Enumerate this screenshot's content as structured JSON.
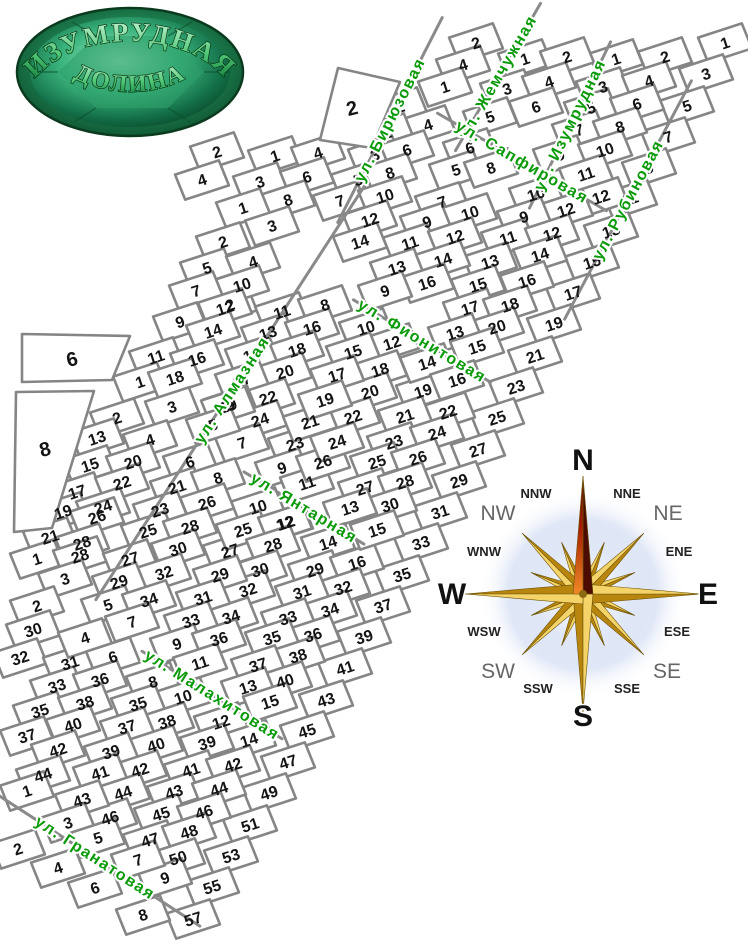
{
  "logo": {
    "line1": "ИЗУМРУДНАЯ",
    "line2": "ДОЛИНА"
  },
  "colors": {
    "street_label": "#0a9a0a",
    "parcel_line": "#858585",
    "number": "#141414",
    "compass_gold_light": "#f4d469",
    "compass_gold_dark": "#b8860f",
    "compass_north_dark": "#4d0c00",
    "logo_green": "#1d7f4e"
  },
  "streets": [
    {
      "name": "ул. Алмазная",
      "x": 232,
      "y": 390,
      "rot": -57,
      "line": 500
    },
    {
      "name": "ул. Бирюзовая",
      "x": 390,
      "y": 120,
      "rot": -63,
      "line": 230
    },
    {
      "name": "ул. Жемчужная",
      "x": 498,
      "y": 77,
      "rot": -60,
      "line": 170
    },
    {
      "name": "ул. Изумрудная",
      "x": 570,
      "y": 125,
      "rot": -64,
      "line": 185
    },
    {
      "name": "ул. Рубиновая",
      "x": 628,
      "y": 200,
      "rot": -62,
      "line": 270
    },
    {
      "name": "ул. Сапфировая",
      "x": 522,
      "y": 162,
      "rot": 30,
      "line": 195
    },
    {
      "name": "ул. Фионитовая",
      "x": 422,
      "y": 341,
      "rot": 31,
      "line": 160
    },
    {
      "name": "ул. Янтарная",
      "x": 304,
      "y": 508,
      "rot": 31,
      "line": 140
    },
    {
      "name": "ул. Малахитовая",
      "x": 212,
      "y": 695,
      "rot": 32,
      "line": 165
    },
    {
      "name": "ул. Гранатовая",
      "x": 95,
      "y": 858,
      "rot": 33,
      "line": 250
    }
  ],
  "big_plots": [
    {
      "n": "6",
      "points": "22,334 130,336 112,380 22,382",
      "lx": 72,
      "ly": 359
    },
    {
      "n": "8",
      "points": "16,392 94,391 52,528 14,532",
      "lx": 45,
      "ly": 449
    },
    {
      "n": "2",
      "points": "320,140 338,68 400,82 372,148",
      "lx": 352,
      "ly": 108
    }
  ],
  "plots": [
    [
      1,
      725,
      43
    ],
    [
      3,
      706,
      74
    ],
    [
      5,
      687,
      106
    ],
    [
      7,
      668,
      137
    ],
    [
      9,
      649,
      168
    ],
    [
      11,
      630,
      199
    ],
    [
      13,
      611,
      231
    ],
    [
      15,
      592,
      262
    ],
    [
      17,
      573,
      293
    ],
    [
      19,
      554,
      324
    ],
    [
      21,
      535,
      356
    ],
    [
      23,
      516,
      387
    ],
    [
      25,
      497,
      418
    ],
    [
      27,
      478,
      450
    ],
    [
      29,
      459,
      481
    ],
    [
      31,
      440,
      512
    ],
    [
      33,
      421,
      543
    ],
    [
      35,
      402,
      575
    ],
    [
      37,
      383,
      606
    ],
    [
      39,
      364,
      637
    ],
    [
      41,
      345,
      668
    ],
    [
      43,
      326,
      700
    ],
    [
      45,
      307,
      731
    ],
    [
      47,
      288,
      762
    ],
    [
      49,
      269,
      793
    ],
    [
      51,
      250,
      825
    ],
    [
      53,
      231,
      856
    ],
    [
      55,
      212,
      887
    ],
    [
      57,
      193,
      919
    ],
    [
      1,
      616,
      59
    ],
    [
      2,
      665,
      57
    ],
    [
      3,
      603,
      87
    ],
    [
      4,
      649,
      81
    ],
    [
      5,
      591,
      108
    ],
    [
      6,
      637,
      104
    ],
    [
      7,
      579,
      130
    ],
    [
      8,
      620,
      127
    ],
    [
      9,
      560,
      155
    ],
    [
      10,
      605,
      150
    ],
    [
      11,
      586,
      174
    ],
    [
      12,
      601,
      197
    ],
    [
      1,
      525,
      59
    ],
    [
      2,
      567,
      57
    ],
    [
      3,
      507,
      89
    ],
    [
      4,
      549,
      82
    ],
    [
      5,
      490,
      117
    ],
    [
      6,
      536,
      107
    ],
    [
      10,
      536,
      194
    ],
    [
      12,
      566,
      210
    ],
    [
      9,
      524,
      217
    ],
    [
      11,
      508,
      238
    ],
    [
      12,
      552,
      234
    ],
    [
      13,
      490,
      262
    ],
    [
      14,
      540,
      255
    ],
    [
      15,
      478,
      285
    ],
    [
      16,
      527,
      281
    ],
    [
      17,
      470,
      308
    ],
    [
      18,
      510,
      305
    ],
    [
      20,
      497,
      327
    ],
    [
      2,
      476,
      43
    ],
    [
      4,
      463,
      65
    ],
    [
      1,
      445,
      87
    ],
    [
      6,
      470,
      148
    ],
    [
      5,
      456,
      170
    ],
    [
      8,
      491,
      168
    ],
    [
      7,
      442,
      202
    ],
    [
      9,
      427,
      222
    ],
    [
      10,
      470,
      213
    ],
    [
      11,
      410,
      243
    ],
    [
      12,
      455,
      237
    ],
    [
      13,
      397,
      268
    ],
    [
      14,
      443,
      260
    ],
    [
      16,
      427,
      283
    ],
    [
      2,
      400,
      107
    ],
    [
      4,
      428,
      125
    ],
    [
      1,
      387,
      133
    ],
    [
      3,
      375,
      155
    ],
    [
      6,
      407,
      150
    ],
    [
      5,
      358,
      180
    ],
    [
      8,
      390,
      173
    ],
    [
      7,
      340,
      201
    ],
    [
      10,
      385,
      196
    ],
    [
      12,
      370,
      220
    ],
    [
      14,
      360,
      242
    ],
    [
      9,
      385,
      291
    ],
    [
      10,
      366,
      328
    ],
    [
      12,
      392,
      343
    ],
    [
      15,
      353,
      352
    ],
    [
      18,
      380,
      370
    ],
    [
      20,
      370,
      392
    ],
    [
      22,
      353,
      417
    ],
    [
      19,
      423,
      391
    ],
    [
      22,
      448,
      412
    ],
    [
      13,
      455,
      333
    ],
    [
      15,
      477,
      347
    ],
    [
      14,
      427,
      363
    ],
    [
      16,
      457,
      380
    ],
    [
      17,
      337,
      375
    ],
    [
      21,
      405,
      416
    ],
    [
      23,
      394,
      442
    ],
    [
      24,
      437,
      433
    ],
    [
      25,
      377,
      462
    ],
    [
      26,
      418,
      458
    ],
    [
      27,
      365,
      488
    ],
    [
      28,
      405,
      482
    ],
    [
      30,
      390,
      505
    ],
    [
      13,
      350,
      508
    ],
    [
      10,
      258,
      507
    ],
    [
      12,
      286,
      523
    ],
    [
      2,
      230,
      305
    ],
    [
      11,
      282,
      312
    ],
    [
      8,
      325,
      305
    ],
    [
      13,
      268,
      333
    ],
    [
      16,
      312,
      328
    ],
    [
      15,
      252,
      355
    ],
    [
      18,
      297,
      350
    ],
    [
      20,
      285,
      372
    ],
    [
      17,
      242,
      380
    ],
    [
      22,
      268,
      398
    ],
    [
      9,
      230,
      405
    ],
    [
      24,
      260,
      420
    ],
    [
      7,
      242,
      443
    ],
    [
      23,
      295,
      444
    ],
    [
      9,
      282,
      468
    ],
    [
      11,
      307,
      483
    ],
    [
      21,
      310,
      422
    ],
    [
      19,
      325,
      400
    ],
    [
      26,
      323,
      462
    ],
    [
      24,
      337,
      442
    ],
    [
      2,
      217,
      152
    ],
    [
      4,
      202,
      180
    ],
    [
      1,
      275,
      156
    ],
    [
      4,
      318,
      153
    ],
    [
      3,
      260,
      182
    ],
    [
      6,
      307,
      177
    ],
    [
      8,
      288,
      200
    ],
    [
      1,
      243,
      208
    ],
    [
      3,
      272,
      226
    ],
    [
      2,
      223,
      242
    ],
    [
      5,
      207,
      268
    ],
    [
      4,
      253,
      262
    ],
    [
      10,
      242,
      285
    ],
    [
      7,
      196,
      291
    ],
    [
      12,
      225,
      308
    ],
    [
      9,
      180,
      322
    ],
    [
      14,
      213,
      331
    ],
    [
      11,
      156,
      357
    ],
    [
      16,
      197,
      359
    ],
    [
      1,
      140,
      382
    ],
    [
      18,
      175,
      378
    ],
    [
      3,
      172,
      407
    ],
    [
      19,
      228,
      406
    ],
    [
      5,
      213,
      425
    ],
    [
      2,
      117,
      418
    ],
    [
      13,
      97,
      438
    ],
    [
      4,
      150,
      440
    ],
    [
      15,
      90,
      465
    ],
    [
      20,
      133,
      462
    ],
    [
      17,
      77,
      492
    ],
    [
      22,
      122,
      483
    ],
    [
      19,
      63,
      512
    ],
    [
      24,
      103,
      507
    ],
    [
      21,
      50,
      537
    ],
    [
      26,
      97,
      517
    ],
    [
      28,
      82,
      543
    ],
    [
      6,
      190,
      462
    ],
    [
      21,
      177,
      487
    ],
    [
      8,
      218,
      478
    ],
    [
      23,
      160,
      510
    ],
    [
      26,
      207,
      503
    ],
    [
      25,
      148,
      531
    ],
    [
      28,
      190,
      527
    ],
    [
      30,
      178,
      549
    ],
    [
      27,
      230,
      551
    ],
    [
      25,
      243,
      530
    ],
    [
      12,
      285,
      523
    ],
    [
      28,
      273,
      545
    ],
    [
      30,
      260,
      570
    ],
    [
      14,
      328,
      543
    ],
    [
      29,
      315,
      570
    ],
    [
      16,
      357,
      563
    ],
    [
      32,
      343,
      588
    ],
    [
      31,
      302,
      592
    ],
    [
      34,
      330,
      610
    ],
    [
      33,
      288,
      618
    ],
    [
      36,
      313,
      635
    ],
    [
      35,
      272,
      638
    ],
    [
      38,
      298,
      656
    ],
    [
      37,
      258,
      665
    ],
    [
      40,
      285,
      681
    ],
    [
      13,
      248,
      687
    ],
    [
      15,
      270,
      702
    ],
    [
      15,
      377,
      530
    ],
    [
      32,
      248,
      590
    ],
    [
      34,
      231,
      617
    ],
    [
      1,
      37,
      559
    ],
    [
      28,
      80,
      556
    ],
    [
      27,
      130,
      559
    ],
    [
      32,
      164,
      573
    ],
    [
      3,
      65,
      579
    ],
    [
      29,
      119,
      582
    ],
    [
      5,
      108,
      605
    ],
    [
      34,
      149,
      600
    ],
    [
      7,
      132,
      622
    ],
    [
      2,
      37,
      606
    ],
    [
      30,
      33,
      630
    ],
    [
      32,
      20,
      658
    ],
    [
      31,
      70,
      663
    ],
    [
      33,
      57,
      686
    ],
    [
      35,
      40,
      711
    ],
    [
      37,
      27,
      736
    ],
    [
      4,
      85,
      638
    ],
    [
      6,
      113,
      657
    ],
    [
      36,
      100,
      680
    ],
    [
      38,
      85,
      703
    ],
    [
      40,
      73,
      725
    ],
    [
      42,
      58,
      750
    ],
    [
      44,
      43,
      775
    ],
    [
      1,
      27,
      791
    ],
    [
      29,
      220,
      575
    ],
    [
      31,
      203,
      598
    ],
    [
      33,
      191,
      621
    ],
    [
      9,
      177,
      644
    ],
    [
      36,
      219,
      639
    ],
    [
      11,
      200,
      663
    ],
    [
      8,
      153,
      682
    ],
    [
      10,
      183,
      697
    ],
    [
      35,
      138,
      704
    ],
    [
      38,
      167,
      722
    ],
    [
      37,
      127,
      727
    ],
    [
      40,
      156,
      745
    ],
    [
      39,
      111,
      752
    ],
    [
      42,
      140,
      770
    ],
    [
      41,
      100,
      773
    ],
    [
      12,
      221,
      722
    ],
    [
      14,
      249,
      740
    ],
    [
      39,
      207,
      743
    ],
    [
      41,
      191,
      770
    ],
    [
      42,
      233,
      765
    ],
    [
      43,
      174,
      792
    ],
    [
      44,
      219,
      789
    ],
    [
      45,
      161,
      814
    ],
    [
      46,
      204,
      812
    ],
    [
      47,
      150,
      840
    ],
    [
      48,
      189,
      832
    ],
    [
      50,
      178,
      858
    ],
    [
      9,
      165,
      878
    ],
    [
      7,
      138,
      860
    ],
    [
      44,
      123,
      793
    ],
    [
      46,
      110,
      818
    ],
    [
      43,
      82,
      800
    ],
    [
      3,
      68,
      823
    ],
    [
      5,
      98,
      838
    ],
    [
      2,
      18,
      849
    ],
    [
      4,
      58,
      868
    ],
    [
      6,
      95,
      888
    ],
    [
      8,
      143,
      915
    ]
  ],
  "compass": {
    "center": {
      "x": 583,
      "y": 594
    },
    "labels": [
      {
        "label": "N",
        "x": 583,
        "y": 470,
        "size": 30
      },
      {
        "label": "S",
        "x": 583,
        "y": 726,
        "size": 30
      },
      {
        "label": "W",
        "x": 452,
        "y": 604,
        "size": 30
      },
      {
        "label": "E",
        "x": 708,
        "y": 604,
        "size": 30
      },
      {
        "label": "NE",
        "x": 668,
        "y": 520,
        "size": 21
      },
      {
        "label": "NW",
        "x": 498,
        "y": 520,
        "size": 21
      },
      {
        "label": "SE",
        "x": 667,
        "y": 678,
        "size": 21
      },
      {
        "label": "SW",
        "x": 498,
        "y": 678,
        "size": 21
      },
      {
        "label": "NNE",
        "x": 627,
        "y": 498,
        "size": 13
      },
      {
        "label": "NNW",
        "x": 536,
        "y": 498,
        "size": 13
      },
      {
        "label": "ENE",
        "x": 679,
        "y": 556,
        "size": 13
      },
      {
        "label": "WNW",
        "x": 484,
        "y": 556,
        "size": 13
      },
      {
        "label": "ESE",
        "x": 677,
        "y": 636,
        "size": 13
      },
      {
        "label": "WSW",
        "x": 484,
        "y": 636,
        "size": 13
      },
      {
        "label": "SSE",
        "x": 627,
        "y": 693,
        "size": 13
      },
      {
        "label": "SSW",
        "x": 538,
        "y": 693,
        "size": 13
      }
    ]
  }
}
